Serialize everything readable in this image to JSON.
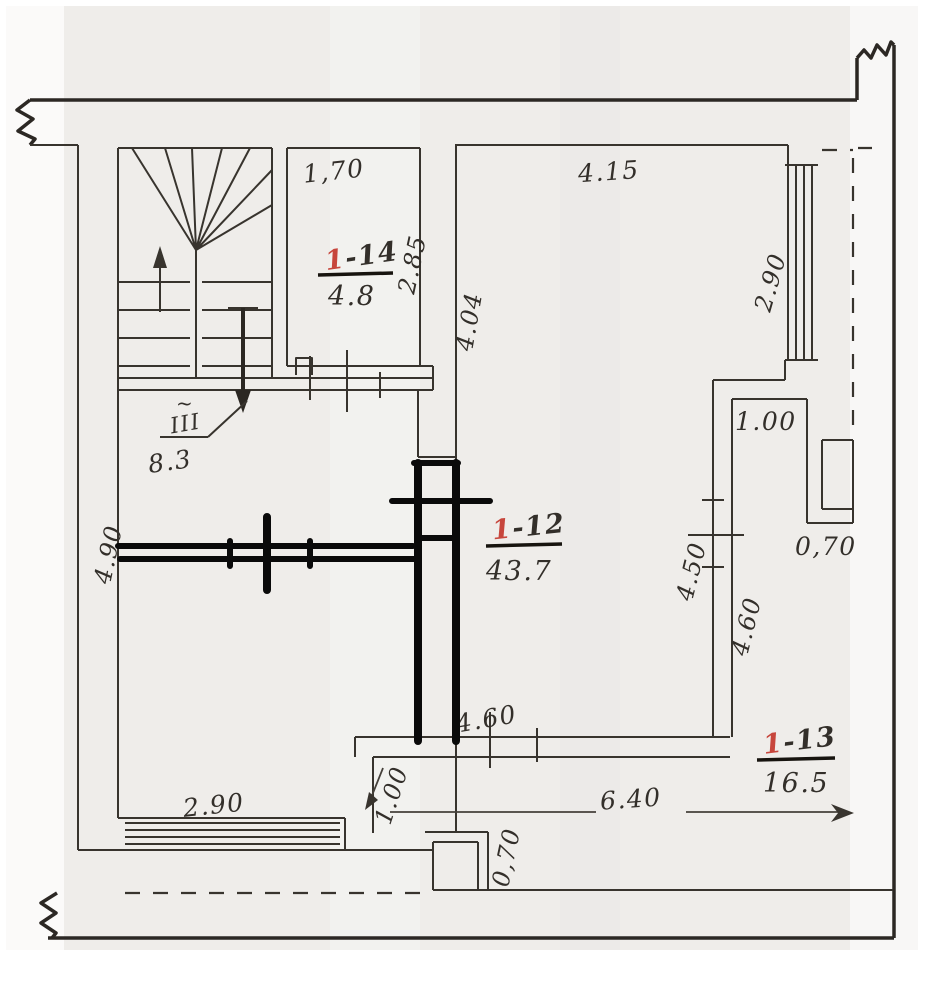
{
  "plan": {
    "rooms": {
      "r14": {
        "num_red": "1",
        "num_rest": "-14",
        "area": "4.8"
      },
      "r12": {
        "num_red": "1",
        "num_rest": "-12",
        "area": "43.7"
      },
      "r13": {
        "num_red": "1",
        "num_rest": "-13",
        "area": "16.5"
      }
    },
    "dims": {
      "d170": "1,70",
      "d285": "2.85",
      "d415": "4.15",
      "d290_right": "2.90",
      "d404": "4.04",
      "d100_shaft": "1.00",
      "d450": "4.50",
      "d460_wall": "4.60",
      "d070_niche": "0,70",
      "d460_bottom": "4.60",
      "d640": "6.40",
      "d100_bottom": "1.00",
      "d290_bottom": "2.90",
      "d070_bottom": "0,70",
      "d490_left": "4.90"
    },
    "stairs": {
      "flight": "III",
      "tilde": "~",
      "area": "8.3"
    },
    "colors": {
      "red": "#c7463c",
      "ink": "#332f2a",
      "marker": "#0a0a0a"
    }
  }
}
